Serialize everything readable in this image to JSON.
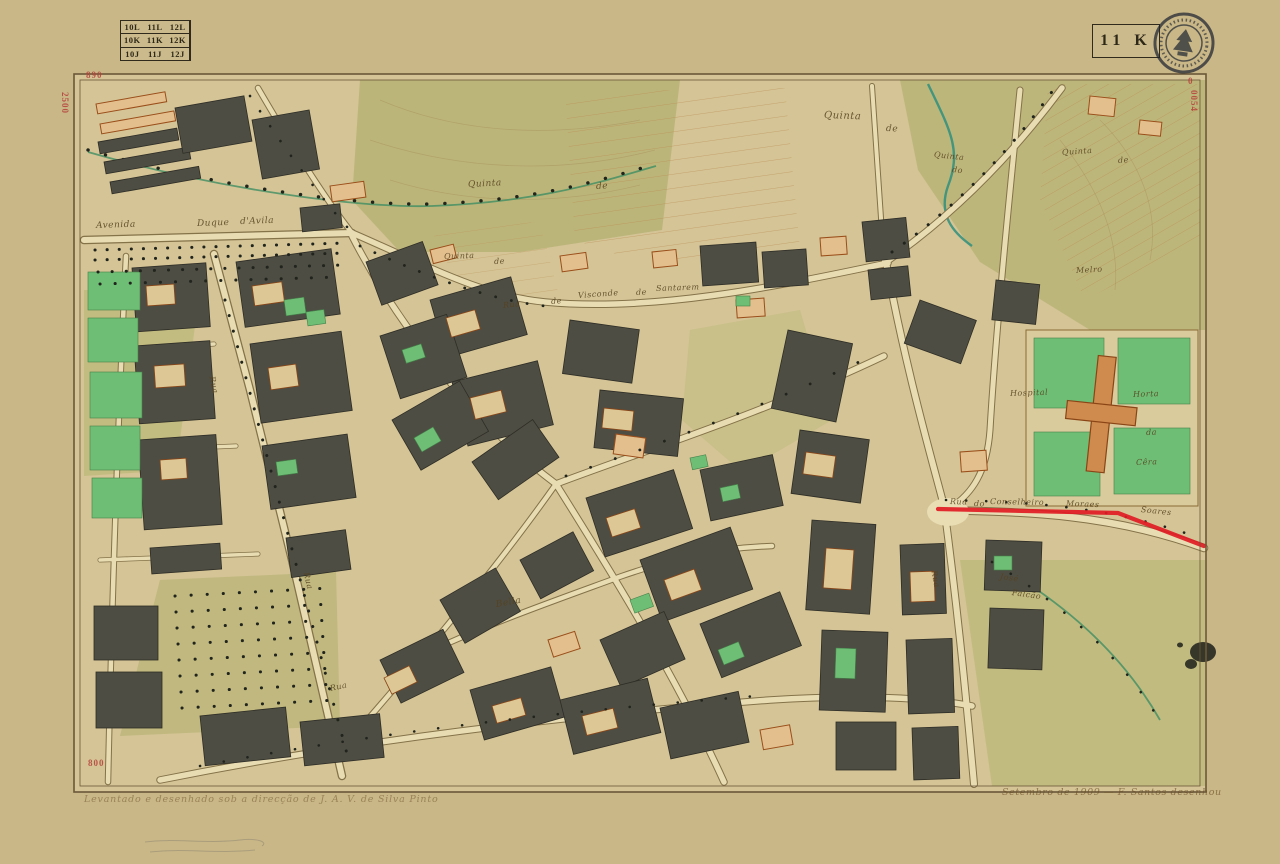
{
  "sheet_label": "11 K",
  "grid_index": {
    "rows": [
      [
        "10L",
        "11L",
        "12L"
      ],
      [
        "10K",
        "11K",
        "12K"
      ],
      [
        "10J",
        "11J",
        "12J"
      ]
    ],
    "current_sheet": "11K"
  },
  "corner_marks": {
    "top_left_h": "890",
    "top_left_v": "2500",
    "bottom_left_h": "800",
    "top_right_h": "0",
    "top_right_v": "0054"
  },
  "inscriptions": {
    "bottom_left": "Levantado e desenhado sob a direcção de J. A. V. de Silva Pinto",
    "bottom_right": "Setembro de 1909 — F. Santos desenhou"
  },
  "colors": {
    "red_overprint": "#e01b24",
    "paper": "#cbb98c",
    "ink": "#3a3226",
    "garden_green": "#6fbe76",
    "building_dark": "#4e4d43",
    "building_orange": "#9a4e1a"
  },
  "map_labels": [
    {
      "t": "Avenida",
      "x": 96,
      "y": 221,
      "r": -2,
      "s": 9
    },
    {
      "t": "Duque",
      "x": 197,
      "y": 219,
      "r": -2,
      "s": 9
    },
    {
      "t": "d'Avila",
      "x": 240,
      "y": 217,
      "r": -2,
      "s": 9
    },
    {
      "t": "Rua",
      "x": 503,
      "y": 301,
      "r": -6,
      "s": 8
    },
    {
      "t": "de",
      "x": 551,
      "y": 297,
      "r": -5,
      "s": 8
    },
    {
      "t": "Visconde",
      "x": 578,
      "y": 291,
      "r": -4,
      "s": 8
    },
    {
      "t": "de",
      "x": 636,
      "y": 288,
      "r": -3,
      "s": 8
    },
    {
      "t": "Santarem",
      "x": 656,
      "y": 284,
      "r": -2,
      "s": 8
    },
    {
      "t": "Quinta",
      "x": 824,
      "y": 110,
      "r": 2,
      "s": 10
    },
    {
      "t": "de",
      "x": 886,
      "y": 124,
      "r": 2,
      "s": 9
    },
    {
      "t": "Quinta",
      "x": 468,
      "y": 180,
      "r": -3,
      "s": 9
    },
    {
      "t": "de",
      "x": 596,
      "y": 182,
      "r": -3,
      "s": 9
    },
    {
      "t": "Quinta",
      "x": 444,
      "y": 252,
      "r": -2,
      "s": 8
    },
    {
      "t": "de",
      "x": 494,
      "y": 257,
      "r": -2,
      "s": 8
    },
    {
      "t": "Quinta",
      "x": 934,
      "y": 150,
      "r": 6,
      "s": 8
    },
    {
      "t": "do",
      "x": 952,
      "y": 165,
      "r": 6,
      "s": 8
    },
    {
      "t": "Quinta",
      "x": 1062,
      "y": 148,
      "r": -4,
      "s": 8
    },
    {
      "t": "de",
      "x": 1118,
      "y": 156,
      "r": -4,
      "s": 8
    },
    {
      "t": "Melro",
      "x": 1076,
      "y": 266,
      "r": -3,
      "s": 8
    },
    {
      "t": "Hospital",
      "x": 1010,
      "y": 389,
      "r": -2,
      "s": 8
    },
    {
      "t": "Horta",
      "x": 1133,
      "y": 390,
      "r": -2,
      "s": 8
    },
    {
      "t": "da",
      "x": 1146,
      "y": 428,
      "r": -2,
      "s": 8
    },
    {
      "t": "Cêra",
      "x": 1136,
      "y": 458,
      "r": -2,
      "s": 8
    },
    {
      "t": "Rua",
      "x": 950,
      "y": 497,
      "r": 2,
      "s": 8
    },
    {
      "t": "do",
      "x": 974,
      "y": 499,
      "r": 2,
      "s": 8
    },
    {
      "t": "Conselheiro",
      "x": 990,
      "y": 497,
      "r": 1,
      "s": 8
    },
    {
      "t": "Moraes",
      "x": 1066,
      "y": 499,
      "r": 2,
      "s": 8
    },
    {
      "t": "Soares",
      "x": 1141,
      "y": 505,
      "r": 6,
      "s": 8
    },
    {
      "t": "Bella",
      "x": 496,
      "y": 600,
      "r": -10,
      "s": 9
    },
    {
      "t": "Rua",
      "x": 212,
      "y": 372,
      "r": 78,
      "s": 8
    },
    {
      "t": "Rua",
      "x": 306,
      "y": 568,
      "r": 76,
      "s": 8
    },
    {
      "t": "Rua",
      "x": 934,
      "y": 566,
      "r": 80,
      "s": 8
    },
    {
      "t": "José",
      "x": 1000,
      "y": 572,
      "r": 8,
      "s": 8
    },
    {
      "t": "Falcão",
      "x": 1012,
      "y": 588,
      "r": 8,
      "s": 8
    },
    {
      "t": "Rua",
      "x": 330,
      "y": 684,
      "r": -12,
      "s": 8
    }
  ]
}
